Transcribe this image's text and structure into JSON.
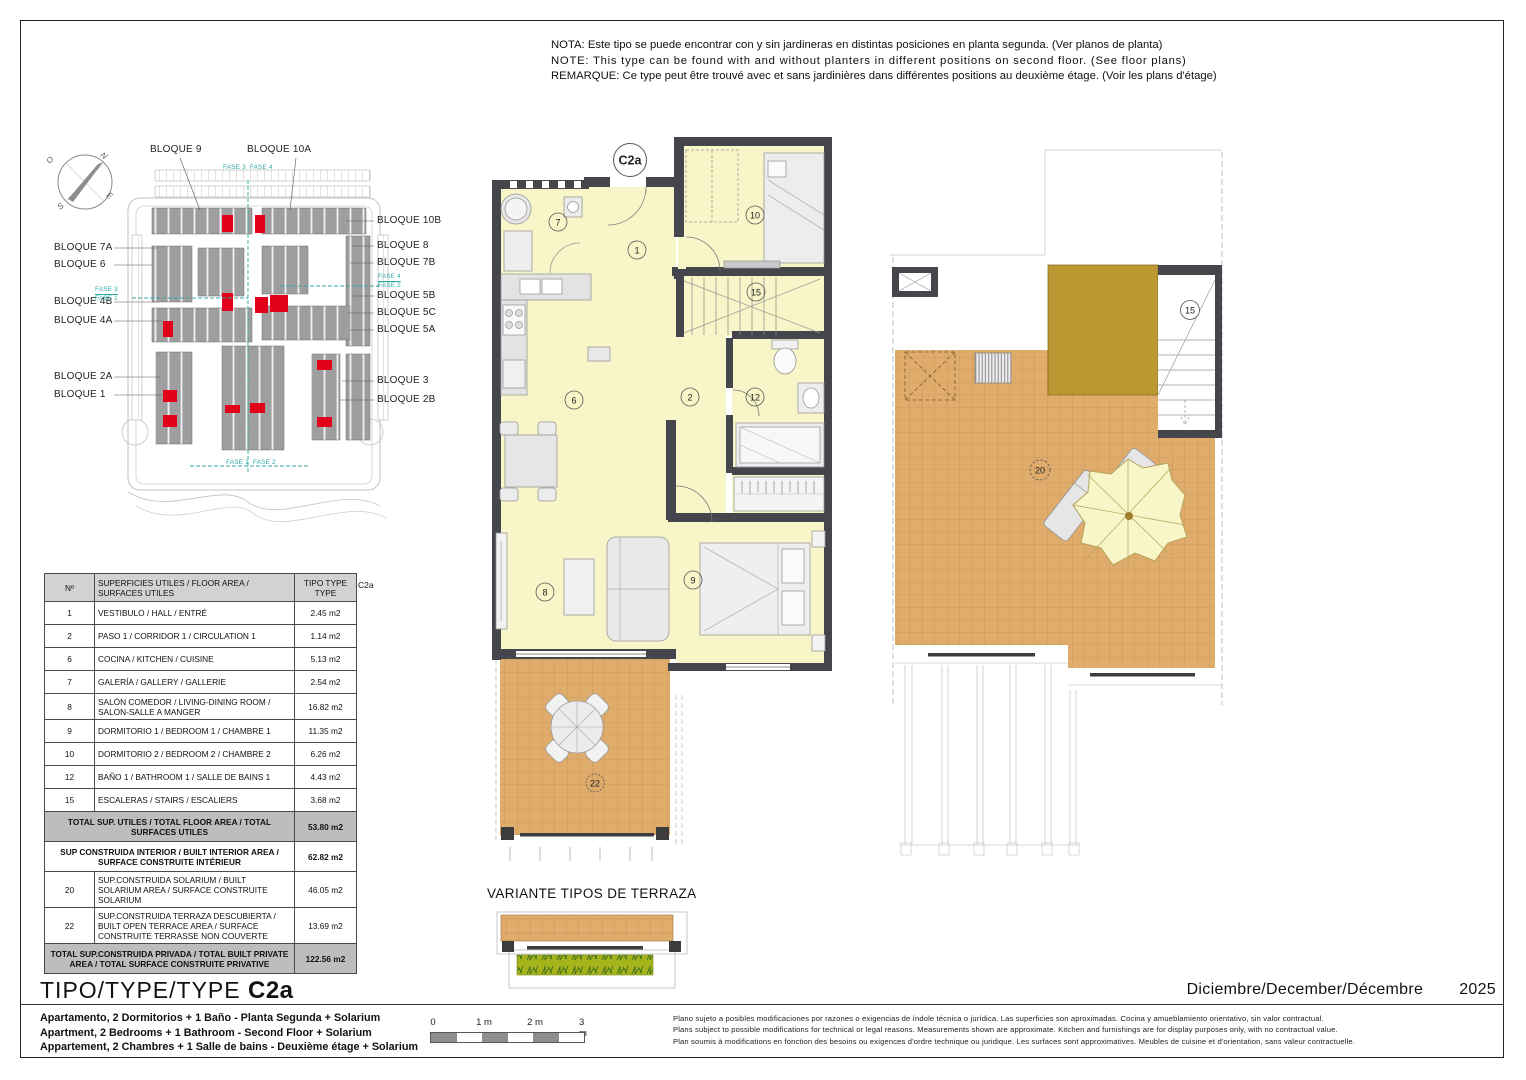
{
  "notes": {
    "es": "NOTA: Este tipo se puede encontrar con y sin jardineras en distintas posiciones en planta segunda. (Ver planos de planta)",
    "en": "NOTE: This type can be found with and without planters in different positions on second floor. (See floor plans)",
    "fr": "REMARQUE: Ce type peut être trouvé avec et sans jardinières dans différentes positions au deuxième étage. (Voir les plans d'étage)"
  },
  "site_plan": {
    "compass": {
      "n": "N",
      "o": "O",
      "s": "S",
      "e": "E"
    },
    "top_labels": [
      "BLOQUE 9",
      "BLOQUE 10A"
    ],
    "left_labels": [
      "BLOQUE 7A",
      "BLOQUE 6",
      "BLOQUE 4B",
      "BLOQUE 4A",
      "BLOQUE 2A",
      "BLOQUE 1"
    ],
    "right_labels": [
      "BLOQUE 10B",
      "BLOQUE 8",
      "BLOQUE 7B",
      "BLOQUE 5B",
      "BLOQUE 5C",
      "BLOQUE 5A",
      "BLOQUE 3",
      "BLOQUE 2B"
    ],
    "fase_top": {
      "left": "FASE 3",
      "right": "FASE 4"
    },
    "fase_left": {
      "top": "FASE 3",
      "bottom": "FASE 1"
    },
    "fase_right": {
      "top": "FASE 4",
      "bottom": "FASE 2"
    },
    "fase_bottom": {
      "left": "FASE 1",
      "right": "FASE 2"
    }
  },
  "floor_plan": {
    "type_badge": "C2a",
    "rooms": {
      "hall": "1",
      "corridor": "2",
      "kitchen": "6",
      "gallery": "7",
      "living": "8",
      "bedroom1": "9",
      "bedroom2": "10",
      "bathroom": "12",
      "stairs": "15",
      "terrace": "22"
    }
  },
  "solarium_plan": {
    "stairs": "15",
    "solarium": "20"
  },
  "variant_title": "VARIANTE TIPOS DE TERRAZA",
  "area_table": {
    "c2a_label": "C2a",
    "headers": {
      "num": "Nº",
      "desc": "SUPERFICIES UTILES / FLOOR AREA / SURFACES UTILES",
      "type": "TIPO TYPE TYPE"
    },
    "rows": [
      {
        "num": "1",
        "desc": "VESTIBULO / HALL / ENTRÉ",
        "value": "2.45 m2"
      },
      {
        "num": "2",
        "desc": "PASO 1 / CORRIDOR 1 / CIRCULATION 1",
        "value": "1.14 m2"
      },
      {
        "num": "6",
        "desc": "COCINA / KITCHEN / CUISINE",
        "value": "5.13 m2"
      },
      {
        "num": "7",
        "desc": "GALERÍA / GALLERY / GALLERIE",
        "value": "2.54 m2"
      },
      {
        "num": "8",
        "desc": "SALÓN COMEDOR  / LIVING-DINING ROOM / SALON-SALLE A MANGER",
        "value": "16.82 m2"
      },
      {
        "num": "9",
        "desc": "DORMITORIO 1 / BEDROOM 1 / CHAMBRE 1",
        "value": "11.35 m2"
      },
      {
        "num": "10",
        "desc": "DORMITORIO 2 / BEDROOM 2 / CHAMBRE 2",
        "value": "6.26 m2"
      },
      {
        "num": "12",
        "desc": "BAÑO 1 / BATHROOM 1 / SALLE DE BAINS 1",
        "value": "4.43 m2"
      },
      {
        "num": "15",
        "desc": "ESCALERAS / STAIRS / ESCALIERS",
        "value": "3.68 m2"
      }
    ],
    "total_utiles": {
      "desc": "TOTAL SUP. UTILES / TOTAL FLOOR AREA / TOTAL SURFACES UTILES",
      "value": "53.80 m2"
    },
    "built_interior": {
      "desc": "SUP CONSTRUIDA INTERIOR / BUILT INTERIOR AREA / SURFACE CONSTRUITE INTÉRIEUR",
      "value": "62.82 m2"
    },
    "extra_rows": [
      {
        "num": "20",
        "desc": "SUP.CONSTRUIDA SOLARIUM / BUILT SOLARIUM  AREA / SURFACE CONSTRUITE SOLARIUM",
        "value": "46.05 m2"
      },
      {
        "num": "22",
        "desc": "SUP.CONSTRUIDA TERRAZA DESCUBIERTA  / BUILT OPEN TERRACE  AREA / SURFACE CONSTRUITE  TERRASSE NON COUVERTE",
        "value": "13.69 m2"
      }
    ],
    "total_private": {
      "desc": "TOTAL SUP.CONSTRUIDA PRIVADA / TOTAL  BUILT PRIVATE AREA / TOTAL SURFACE CONSTRUITE PRIVATIVE",
      "value": "122.56 m2"
    }
  },
  "title_block": {
    "title_prefix": "TIPO/TYPE/TYPE",
    "title_type": "C2a",
    "desc_es": "Apartamento, 2 Dormitorios + 1 Baño - Planta Segunda + Solarium",
    "desc_en": "Apartment, 2 Bedrooms + 1 Bathroom - Second Floor + Solarium",
    "desc_fr": "Appartement, 2 Chambres + 1 Salle de bains - Deuxième étage + Solarium",
    "date": "Diciembre/December/Décembre",
    "year": "2025"
  },
  "scale_bar": {
    "ticks": [
      "0",
      "1 m",
      "2 m",
      "3 m"
    ]
  },
  "disclaimer": {
    "es": "Plano sujeto a posibles modificaciones por razones o exigencias de índole técnica o jurídica. Las superficies son aproximadas. Cocina y amueblamiento orientativo, sin valor contractual.",
    "en": "Plans subject to possible modifications for technical or legal reasons. Measurements shown are approximate. Kitchen and furnishings are for display purposes only, with no contractual value.",
    "fr": "Plan soumis à modifications en fonction des besoins ou exigences d'ordre technique ou juridique. Les surfaces sont approximatives. Meubles de cuisine et d'orientation, sans valeur contractuelle."
  },
  "colors": {
    "wall": "#45464b",
    "room": "#F8F5C8",
    "tile": "#DFAC6C",
    "olive": "#BC9832",
    "highlight_red": "#E2001A",
    "phase_teal": "#2FA8A4",
    "planter_green": "#A6B41C"
  }
}
